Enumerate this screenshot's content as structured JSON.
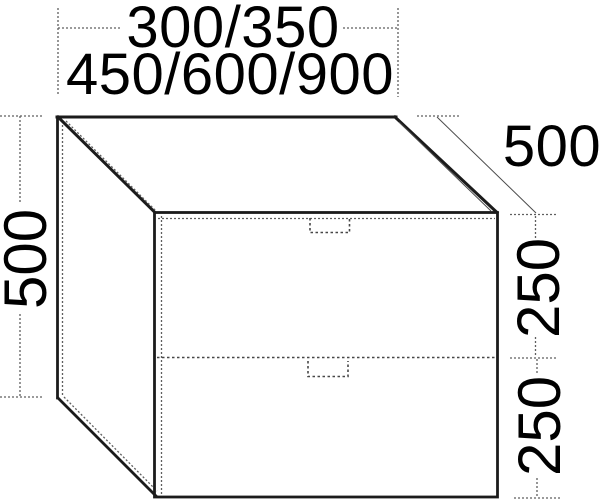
{
  "diagram": {
    "title": "Two-drawer cabinet isometric dimension drawing",
    "dimensions": {
      "width_line1": "300/350",
      "width_line2": "450/600/900",
      "height": "500",
      "depth": "500",
      "upper_drawer_height": "250",
      "lower_drawer_height": "250"
    },
    "colors": {
      "background": "#ffffff",
      "edge": "#1b1b1b",
      "dimension_line": "#5f5f5f",
      "text": "#000000"
    }
  }
}
